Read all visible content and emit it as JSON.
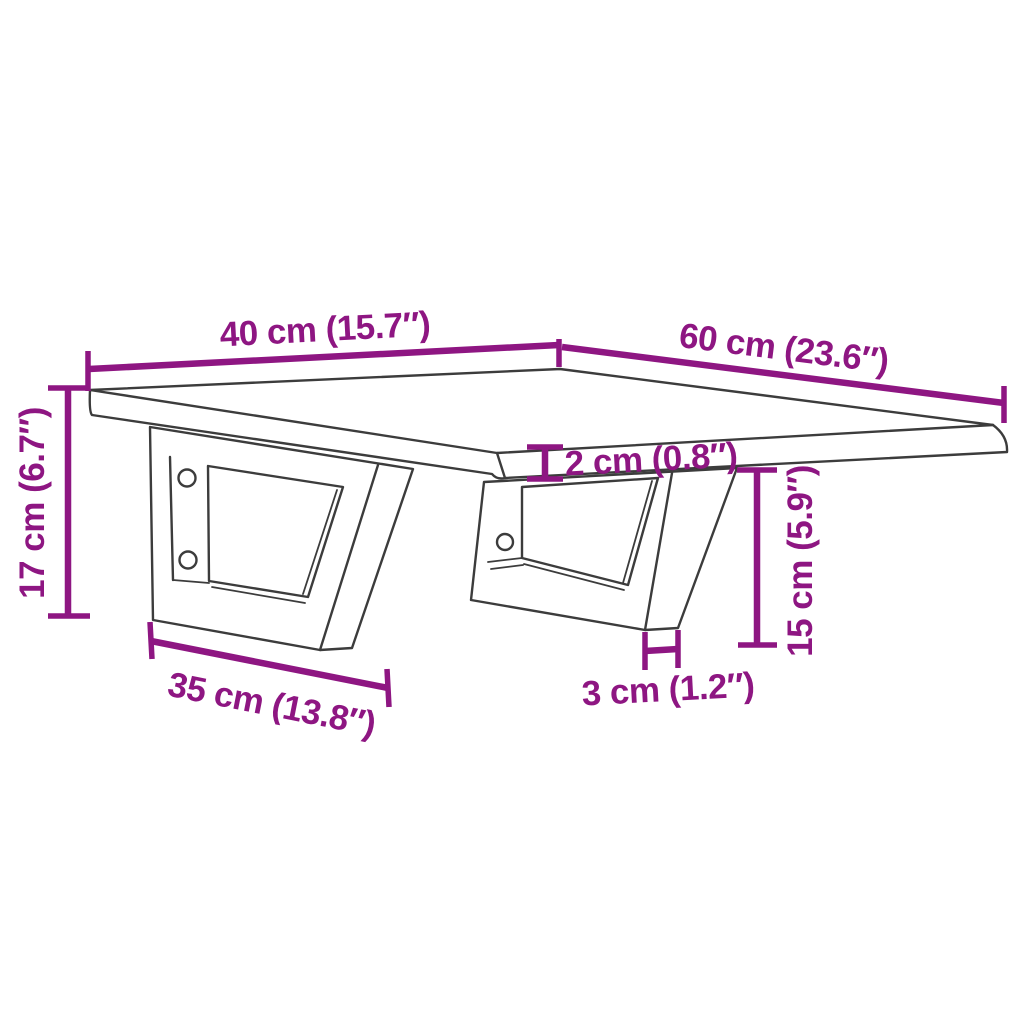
{
  "title": "Wall-mounted shelf with steel brackets - dimension diagram",
  "colors": {
    "dimension": "#8E1682",
    "outline": "#3c3c3c",
    "background": "#ffffff"
  },
  "labels": {
    "top_width": "40 cm (15.7″)",
    "top_depth": "60 cm (23.6″)",
    "bracket_height": "17 cm (6.7″)",
    "top_thickness": "2 cm (0.8″)",
    "bracket_drop": "15 cm (5.9″)",
    "bracket_length": "35 cm (13.8″)",
    "strip_width": "3 cm (1.2″)"
  },
  "values": {
    "top_width": {
      "cm": 40,
      "inches": 15.7
    },
    "top_depth": {
      "cm": 60,
      "inches": 23.6
    },
    "bracket_height": {
      "cm": 17,
      "inches": 6.7
    },
    "top_thickness": {
      "cm": 2,
      "inches": 0.8
    },
    "bracket_drop": {
      "cm": 15,
      "inches": 5.9
    },
    "bracket_length": {
      "cm": 35,
      "inches": 13.8
    },
    "strip_width": {
      "cm": 3,
      "inches": 1.2
    }
  }
}
